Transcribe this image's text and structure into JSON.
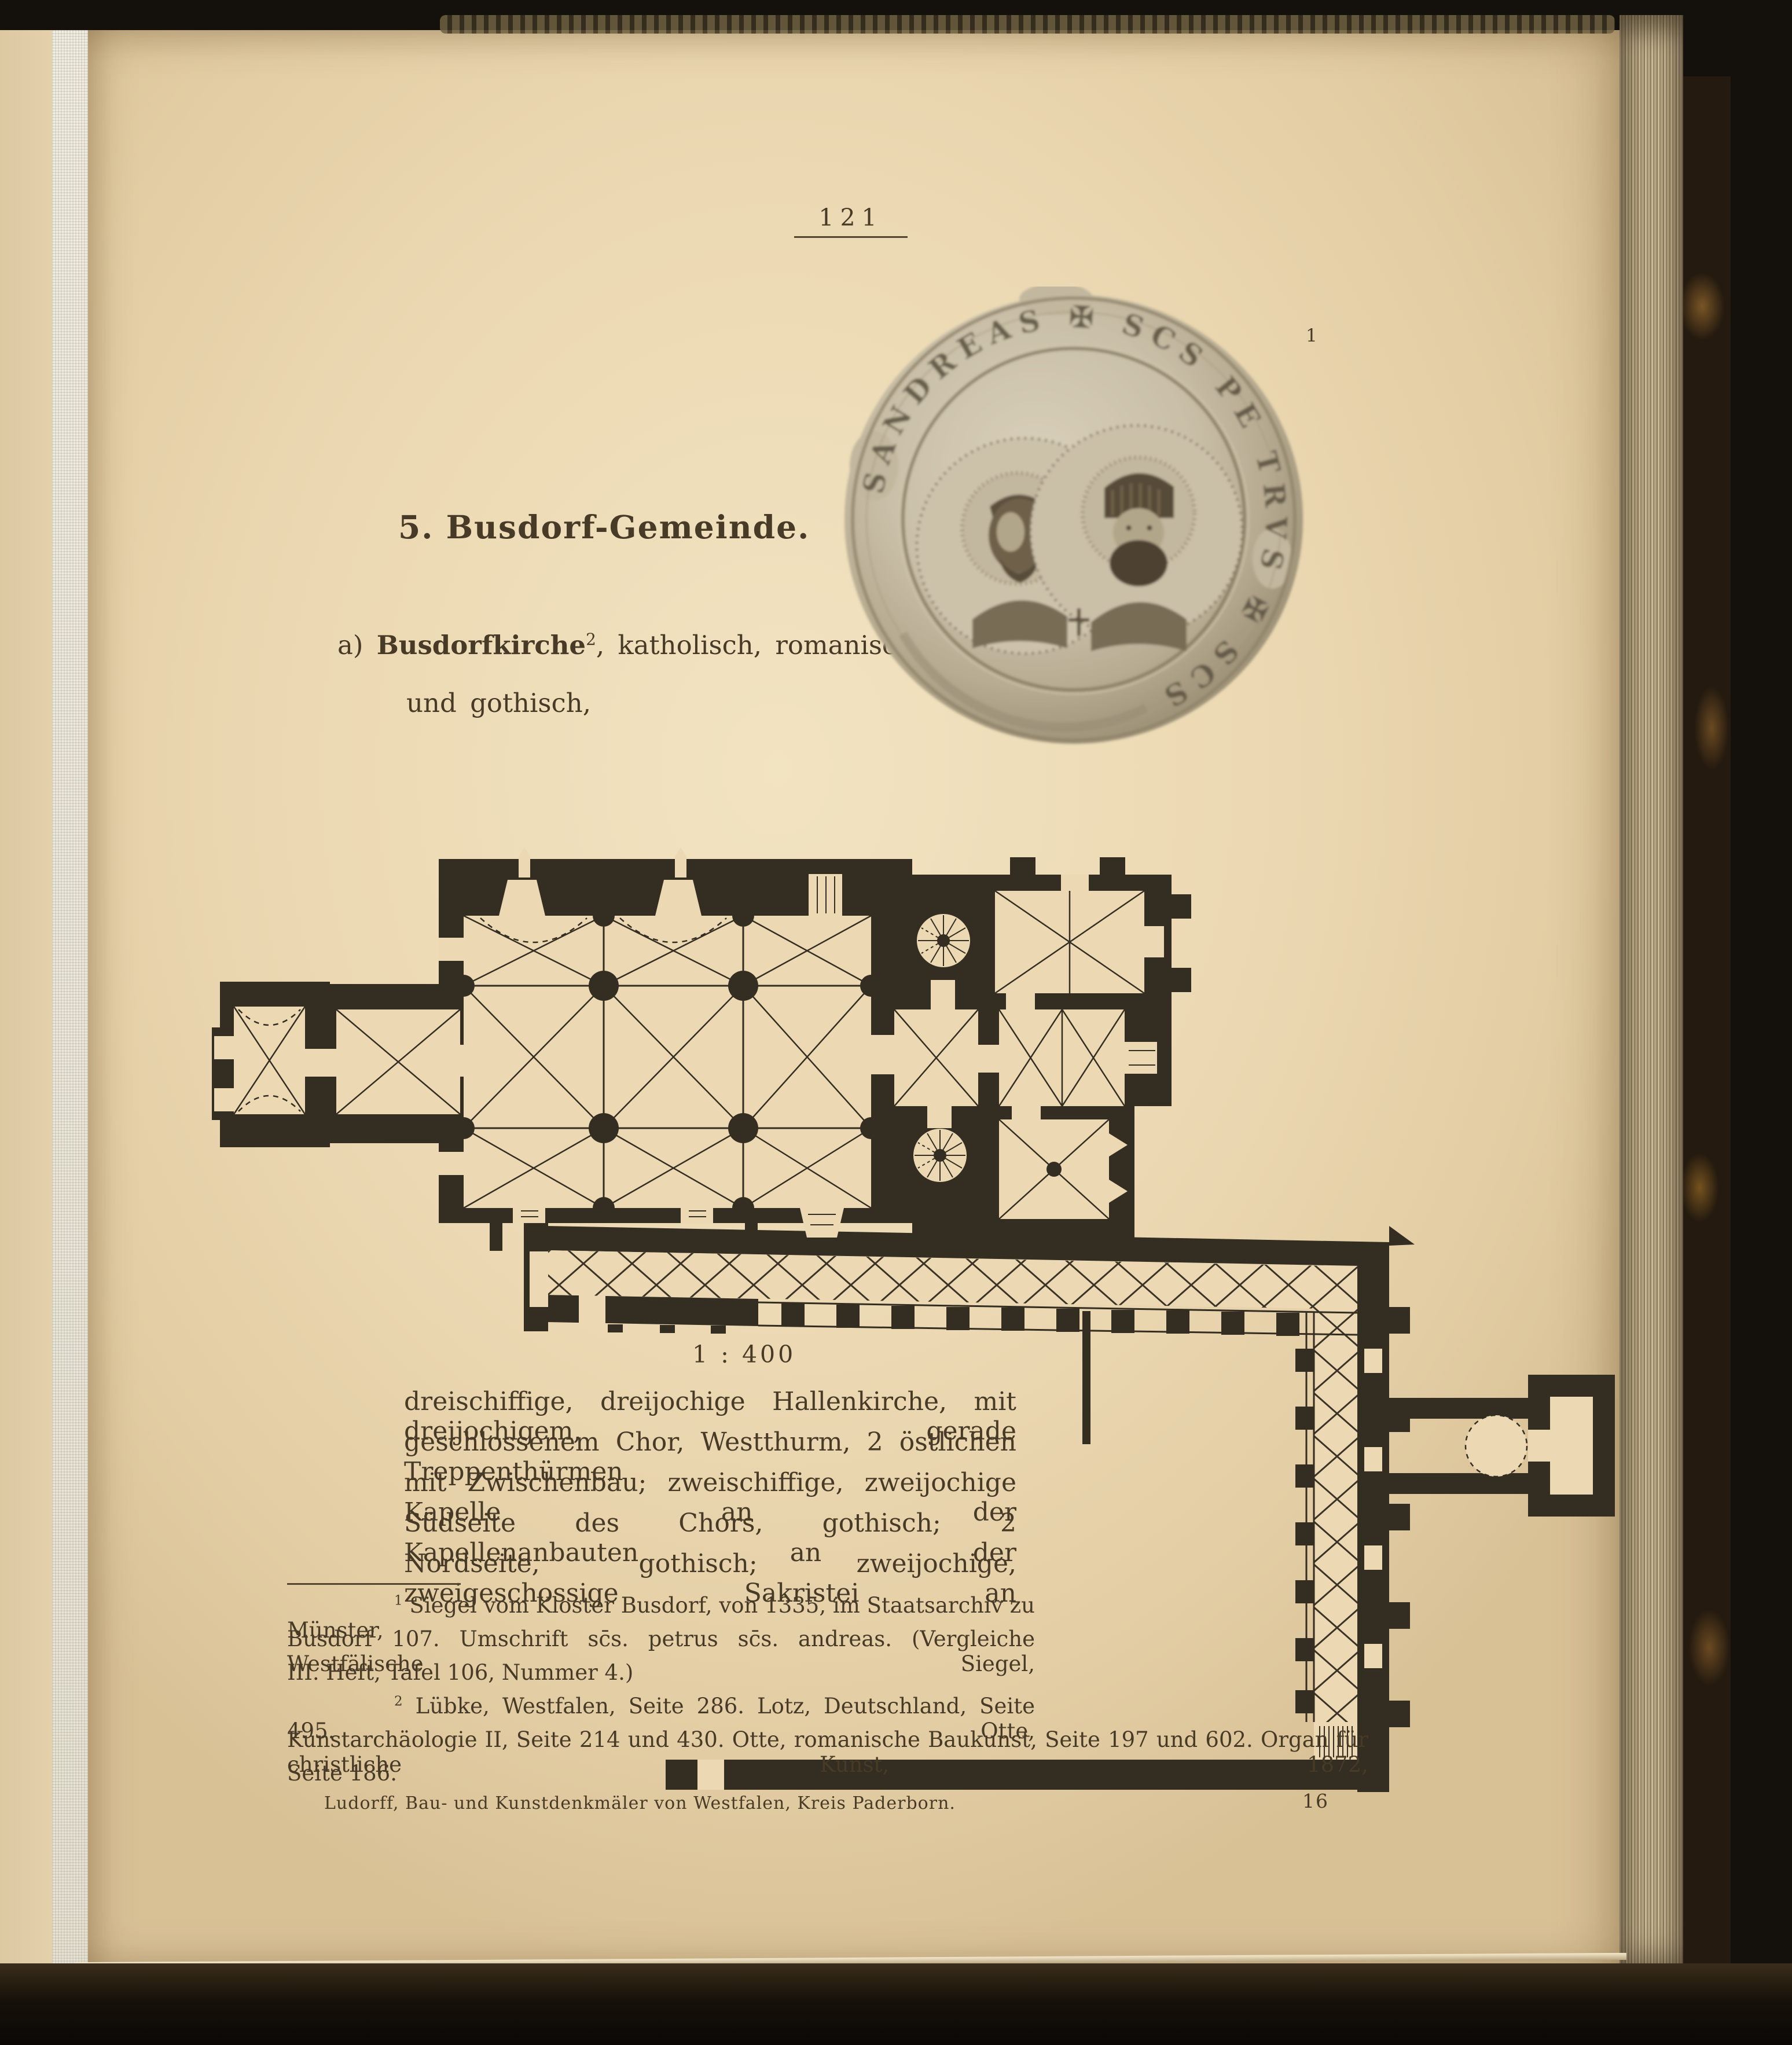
{
  "page": {
    "number": "121",
    "footer_title": "Ludorff, Bau- und Kunstdenkmäler von Westfalen, Kreis Paderborn.",
    "sheet_number": "16"
  },
  "heading": "5. Busdorf-Gemeinde.",
  "subheading": {
    "prefix": "a)",
    "church_name": "Busdorfkirche",
    "footnote_ref": "2",
    "rest": ", katholisch, romanisch",
    "line2": "und gothisch,"
  },
  "seal": {
    "figure_number": "1",
    "inscription": "SANDREAS ✠ SCS PE TRVS ✠ SCS"
  },
  "plan": {
    "scale_label": "1 : 400"
  },
  "body": {
    "lines": [
      "dreischiffige, dreijochige Hallenkirche, mit dreijochigem, gerade",
      "geschlossenem Chor, Westthurm, 2 östlichen Treppenthürmen",
      "mit Zwischenbau; zweischiffige, zweijochige Kapelle an der",
      "Südseite des Chors, gothisch; 2 Kapellenanbauten an der",
      "Nordseite, gothisch; zweijochige, zweigeschossige Sakristei an"
    ]
  },
  "footnotes": {
    "fn1": {
      "marker": "1",
      "lines": [
        "Siegel vom Kloster Busdorf, von 1335, im Staatsarchiv zu Münster,",
        "Busdorf 107.  Umschrift sc̄s. petrus sc̄s. andreas.  (Vergleiche Westfälische Siegel,",
        "III. Heft, Tafel 106, Nummer 4.)"
      ]
    },
    "fn2": {
      "marker": "2",
      "lines": [
        "Lübke, Westfalen, Seite 286.  Lotz, Deutschland, Seite 495.  Otte,",
        "Kunstarchäologie II, Seite 214 und 430.  Otte, romanische Baukunst, Seite 197 und 602.  Organ für christliche Kunst, 1872,",
        "Seite 186."
      ]
    }
  },
  "colors": {
    "paper": "#ead7b0",
    "ink": "#473a26",
    "plan_ink": "#332d22",
    "seal_base": "#c6bca4"
  }
}
